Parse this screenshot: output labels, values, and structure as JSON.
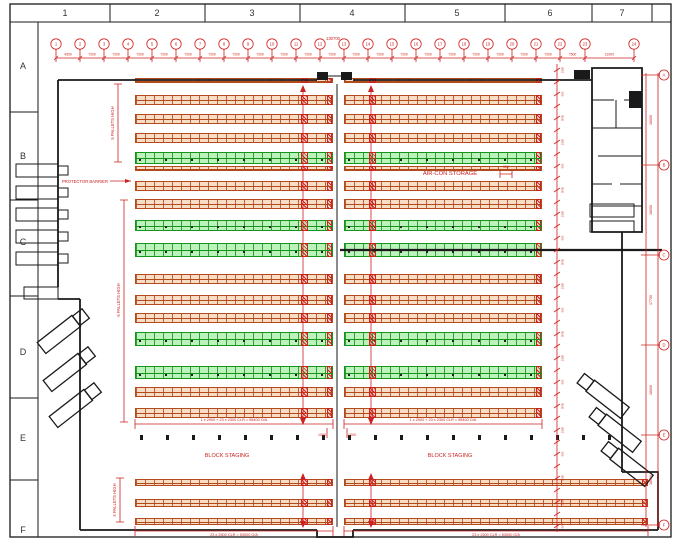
{
  "sheet": {
    "top_zones": [
      "1",
      "2",
      "3",
      "4",
      "5",
      "6",
      "7"
    ],
    "side_zones": [
      "A",
      "B",
      "C",
      "D",
      "E",
      "F"
    ]
  },
  "top_grid": {
    "overall_dim": "130700",
    "bubbles": [
      "1",
      "2",
      "3",
      "4",
      "5",
      "6",
      "7",
      "8",
      "9",
      "10",
      "11",
      "12",
      "13",
      "14",
      "15",
      "16",
      "17",
      "18",
      "19",
      "20",
      "21",
      "22",
      "23",
      "24"
    ],
    "dims": [
      "4300",
      "7200",
      "7200",
      "7200",
      "7200",
      "7200",
      "7200",
      "7200",
      "7200",
      "7200",
      "7200",
      "7200",
      "7200",
      "7200",
      "7200",
      "7200",
      "7200",
      "7200",
      "7200",
      "7200",
      "7200",
      "7500",
      "11000"
    ]
  },
  "right_grid": {
    "bubbles": [
      "A",
      "B",
      "C",
      "D",
      "E",
      "F"
    ],
    "dims": [
      "18000",
      "18000",
      "17700",
      "18000",
      "18000"
    ]
  },
  "row_dim_chain": {
    "labels": [
      "2300",
      "500",
      "3000"
    ]
  },
  "labels": {
    "aircon": "AIR-CON STORAGE",
    "protector": "PROTECTOR BARRIER",
    "block_staging_left": "BLOCK STAGING",
    "block_staging_right": "BLOCK STAGING",
    "pallets_5": "5 PALLETS HIGH",
    "pallets_6": "6 PALLETS HIGH",
    "pallets_4": "4 PALLETS HIGH",
    "rack_dim_left": "1 x 2900 + 23 x 2300 CLR = 55400 O/A",
    "rack_dim_right": "1 x 2900 + 23 x 2300 CLR = 55400 O/A",
    "bottom_dim_left": "23 x 2300 CLR = 53000 O/A",
    "bottom_dim_right": "23 x 2300 CLR = 53000 O/A",
    "aisle_dim_a": "1000",
    "aisle_dim_b": "1000",
    "small_dim_500": "500"
  },
  "colors": {
    "red": "#cc2222",
    "rack_orange_line": "#b34a1c",
    "rack_orange_fill": "#eea66a",
    "rack_green_line": "#17941b",
    "rack_green_fill": "#7ae47a",
    "wall_black": "#1a1a1a"
  },
  "racks": {
    "banks_main": [
      [
        135,
        333
      ],
      [
        344,
        542
      ]
    ],
    "banks_bottom": [
      [
        135,
        333
      ],
      [
        344,
        648
      ]
    ],
    "flues": [
      303,
      371
    ],
    "rows": [
      {
        "y": 78,
        "h": 5,
        "c": "o",
        "t": "main"
      },
      {
        "y": 95,
        "h": 10,
        "c": "o",
        "t": "main"
      },
      {
        "y": 114,
        "h": 10,
        "c": "o",
        "t": "main"
      },
      {
        "y": 133,
        "h": 10,
        "c": "o",
        "t": "main"
      },
      {
        "y": 152,
        "h": 12,
        "c": "g",
        "t": "main"
      },
      {
        "y": 166,
        "h": 5,
        "c": "o",
        "t": "main"
      },
      {
        "y": 181,
        "h": 10,
        "c": "o",
        "t": "main"
      },
      {
        "y": 199,
        "h": 10,
        "c": "o",
        "t": "main"
      },
      {
        "y": 220,
        "h": 11,
        "c": "g",
        "t": "main"
      },
      {
        "y": 243,
        "h": 14,
        "c": "g",
        "t": "main"
      },
      {
        "y": 274,
        "h": 10,
        "c": "o",
        "t": "main"
      },
      {
        "y": 295,
        "h": 10,
        "c": "o",
        "t": "main"
      },
      {
        "y": 313,
        "h": 10,
        "c": "o",
        "t": "main"
      },
      {
        "y": 332,
        "h": 14,
        "c": "g",
        "t": "main"
      },
      {
        "y": 366,
        "h": 13,
        "c": "g",
        "t": "main"
      },
      {
        "y": 387,
        "h": 10,
        "c": "o",
        "t": "main"
      },
      {
        "y": 408,
        "h": 10,
        "c": "o",
        "t": "main"
      },
      {
        "y": 479,
        "h": 7,
        "c": "o",
        "t": "bottom"
      },
      {
        "y": 499,
        "h": 8,
        "c": "o",
        "t": "bottom"
      },
      {
        "y": 518,
        "h": 7,
        "c": "o",
        "t": "bottom"
      }
    ]
  },
  "dock_rows_left_y": [
    164,
    186,
    208,
    230,
    252
  ],
  "staging_ticks": {
    "count": 19,
    "y": 435
  }
}
